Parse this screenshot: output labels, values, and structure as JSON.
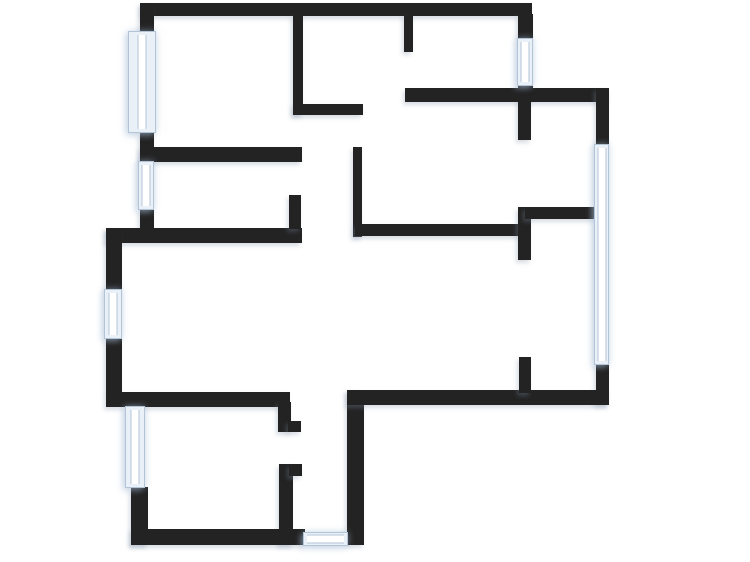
{
  "meta": {
    "title": "Apartment floor plan",
    "type": "architectural-floor-plan",
    "visible_text": []
  },
  "canvas": {
    "width": 750,
    "height": 562,
    "background": "#ffffff"
  },
  "colors": {
    "wall": "#232323",
    "window_fill": "#e9f0f7",
    "window_frame": "#b3c4d7",
    "window_glass": "#ffffff"
  },
  "walls": [
    {
      "name": "exterior-top-wall",
      "x": 142,
      "y": 3,
      "w": 390,
      "h": 13
    },
    {
      "name": "exterior-left-wall-upper-a",
      "x": 140,
      "y": 3,
      "w": 14,
      "h": 31
    },
    {
      "name": "exterior-left-wall-upper-b",
      "x": 140,
      "y": 132,
      "w": 14,
      "h": 30
    },
    {
      "name": "exterior-left-wall-upper-c",
      "x": 140,
      "y": 209,
      "w": 14,
      "h": 22
    },
    {
      "name": "interior-wall-topleft-room-bottom",
      "x": 140,
      "y": 147,
      "w": 162,
      "h": 15
    },
    {
      "name": "interior-wall-vertical-a",
      "x": 293,
      "y": 14,
      "w": 10,
      "h": 101
    },
    {
      "name": "interior-wall-horizontal-b",
      "x": 293,
      "y": 104,
      "w": 70,
      "h": 11
    },
    {
      "name": "interior-wall-vertical-top-mid",
      "x": 404,
      "y": 14,
      "w": 9,
      "h": 38
    },
    {
      "name": "exterior-topright-wall-upper",
      "x": 518,
      "y": 14,
      "w": 15,
      "h": 25
    },
    {
      "name": "exterior-topright-wall-lower",
      "x": 518,
      "y": 84,
      "w": 15,
      "h": 18
    },
    {
      "name": "exterior-topright-horizontal",
      "x": 405,
      "y": 88,
      "w": 204,
      "h": 14
    },
    {
      "name": "interior-stub-below-topright",
      "x": 518,
      "y": 102,
      "w": 13,
      "h": 38
    },
    {
      "name": "exterior-right-wall-upper",
      "x": 596,
      "y": 88,
      "w": 13,
      "h": 57
    },
    {
      "name": "exterior-right-wall-lower",
      "x": 596,
      "y": 363,
      "w": 13,
      "h": 42
    },
    {
      "name": "interior-wall-vertical-e",
      "x": 353,
      "y": 147,
      "w": 9,
      "h": 90
    },
    {
      "name": "interior-wall-horizontal-1",
      "x": 106,
      "y": 228,
      "w": 196,
      "h": 15
    },
    {
      "name": "interior-wall-vertical-stub-1",
      "x": 289,
      "y": 195,
      "w": 12,
      "h": 34
    },
    {
      "name": "interior-wall-horizontal-2",
      "x": 355,
      "y": 224,
      "w": 170,
      "h": 12
    },
    {
      "name": "interior-wall-vertical-jog",
      "x": 518,
      "y": 207,
      "w": 13,
      "h": 53
    },
    {
      "name": "interior-wall-horizontal-3",
      "x": 525,
      "y": 207,
      "w": 72,
      "h": 12
    },
    {
      "name": "exterior-left-wall-lower-a",
      "x": 106,
      "y": 228,
      "w": 16,
      "h": 63
    },
    {
      "name": "exterior-left-wall-lower-b",
      "x": 106,
      "y": 337,
      "w": 16,
      "h": 56
    },
    {
      "name": "interior-wall-bottomleft-room-top",
      "x": 106,
      "y": 392,
      "w": 184,
      "h": 15
    },
    {
      "name": "interior-step-vertical",
      "x": 278,
      "y": 402,
      "w": 13,
      "h": 30
    },
    {
      "name": "interior-step-stub-a",
      "x": 288,
      "y": 421,
      "w": 13,
      "h": 11
    },
    {
      "name": "interior-bottomleft-room-right-wall",
      "x": 279,
      "y": 464,
      "w": 14,
      "h": 81
    },
    {
      "name": "interior-step-stub-b",
      "x": 289,
      "y": 464,
      "w": 13,
      "h": 12
    },
    {
      "name": "exterior-bottomleft-room-left-wall",
      "x": 131,
      "y": 487,
      "w": 17,
      "h": 58
    },
    {
      "name": "exterior-bottom-wall-left",
      "x": 131,
      "y": 529,
      "w": 174,
      "h": 16
    },
    {
      "name": "interior-wall-vertical-2",
      "x": 347,
      "y": 390,
      "w": 17,
      "h": 155
    },
    {
      "name": "exterior-bottom-wall-right",
      "x": 347,
      "y": 390,
      "w": 262,
      "h": 15
    },
    {
      "name": "interior-stub-bottom-right",
      "x": 519,
      "y": 357,
      "w": 12,
      "h": 36
    }
  ],
  "windows": [
    {
      "name": "window-upper-left",
      "x": 128,
      "y": 31,
      "w": 28,
      "h": 102,
      "orientation": "v"
    },
    {
      "name": "window-left-middle",
      "x": 138,
      "y": 161,
      "w": 16,
      "h": 49,
      "orientation": "v"
    },
    {
      "name": "window-top-right",
      "x": 517,
      "y": 38,
      "w": 16,
      "h": 48,
      "orientation": "v"
    },
    {
      "name": "window-left-lower",
      "x": 104,
      "y": 289,
      "w": 18,
      "h": 50,
      "orientation": "v"
    },
    {
      "name": "window-bottomleft-room",
      "x": 125,
      "y": 406,
      "w": 20,
      "h": 82,
      "orientation": "v"
    },
    {
      "name": "window-right",
      "x": 594,
      "y": 144,
      "w": 15,
      "h": 221,
      "orientation": "v"
    },
    {
      "name": "window-bottom",
      "x": 303,
      "y": 532,
      "w": 45,
      "h": 14,
      "orientation": "h"
    }
  ]
}
